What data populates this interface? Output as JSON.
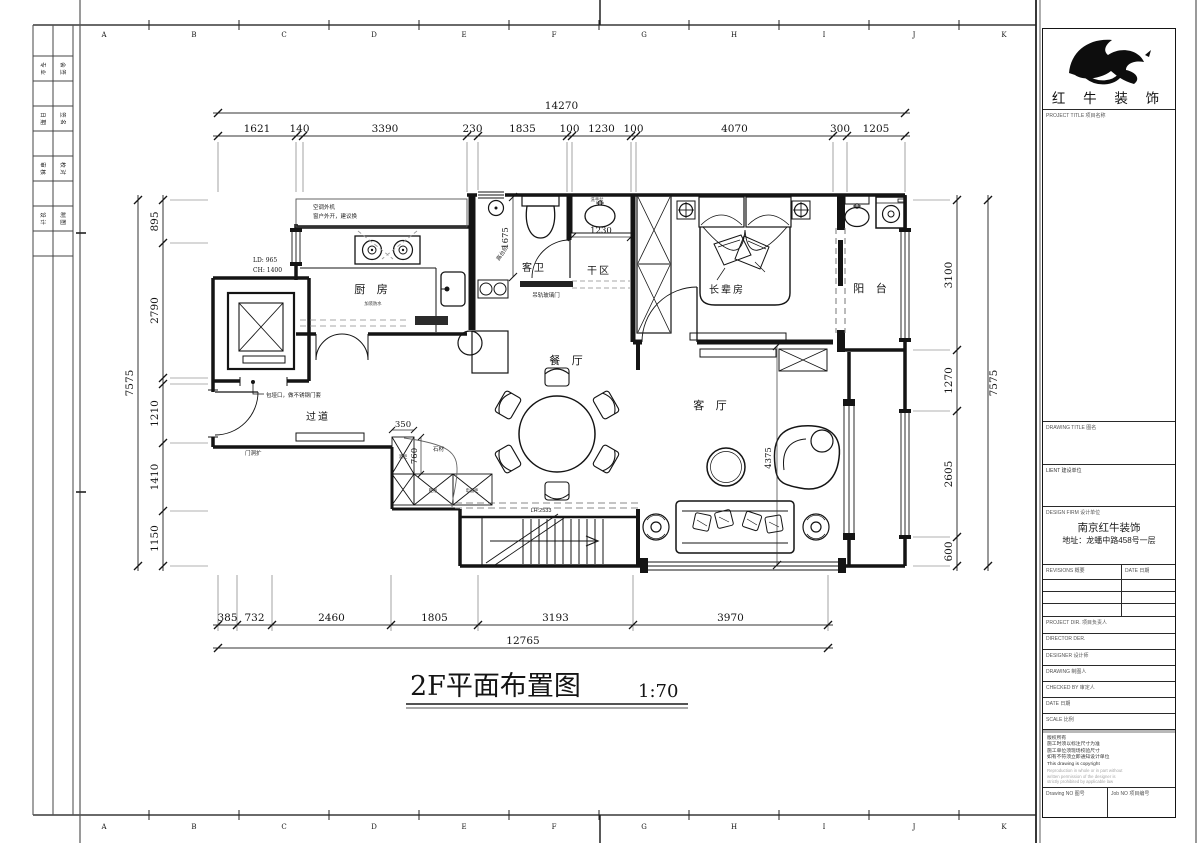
{
  "sheet": {
    "grid_letters": [
      "A",
      "B",
      "C",
      "D",
      "E",
      "F",
      "G",
      "H",
      "I",
      "J",
      "K"
    ],
    "margin_cells": [
      "专 业",
      "会 签",
      "日 期",
      "签 名",
      "审 核",
      "校 对",
      "设 计",
      "制 图"
    ]
  },
  "dims": {
    "top_total": "14270",
    "top": [
      "1621",
      "140",
      "3390",
      "230",
      "1835",
      "100",
      "1230",
      "100",
      "4070",
      "300",
      "1205"
    ],
    "bottom_total": "12765",
    "bottom": [
      "385",
      "732",
      "2460",
      "1805",
      "3193",
      "3970"
    ],
    "left_total": "7575",
    "left": [
      "895",
      "2790",
      "1210",
      "1410",
      "1150"
    ],
    "right_total": "7575",
    "right": [
      "3100",
      "1270",
      "2605",
      "600"
    ],
    "inner": {
      "bath_height": "1675",
      "dry_width": "1230",
      "cab_width": "350",
      "cab_depth": "760",
      "living_height": "4375",
      "stair_note": "LH:2533",
      "elev_ld": "LD: 965",
      "elev_ch": "CH: 1400"
    }
  },
  "rooms": {
    "kitchen": "厨 房",
    "guest_bath": "客卫",
    "dry_area": "干区",
    "elder_room": "长辈房",
    "balcony": "阳 台",
    "dining": "餐 厅",
    "living": "客 厅",
    "corridor": "过道"
  },
  "annotations": {
    "ac_note1": "空调外机",
    "ac_note2": "窗户外开，建议换",
    "kitchen_note": "加装防水",
    "step_note": "高台阶",
    "slide_door": "吊轨玻璃门",
    "opening_note": "包垭口，做不锈钢门套",
    "door_note": "门洞扩",
    "stone": "石材",
    "cab_tall": "酒柜",
    "cab_mid": "鞋柜",
    "cab_right": "电器柜",
    "basin": "洗手盆"
  },
  "title": {
    "text": "2F平面布置图",
    "scale": "1:70"
  },
  "titleblock": {
    "brand": "红 牛 装 饰",
    "project_title_label": "PROJECT TITLE   项目名称",
    "drawing_title_label": "DRAWING TITLE   图名",
    "client_label": "LIENT   建设单位",
    "design_firm_label": "DESIGN FIRM   设计单位",
    "firm_name": "南京红牛装饰",
    "firm_addr": "地址：龙蟠中路458号一层",
    "revisions_label": "REVISIONS   概要",
    "date_col_label": "DATE   日期",
    "project_dir_label": "PROJECT DIR.   项目负责人",
    "director_label": "DIRECTOR DER.",
    "designer_label": "DESIGNER   设计师",
    "drawing_label": "DRAWING   制图人",
    "checked_label": "CHECKED BY   审定人",
    "date_label": "DATE   日期",
    "scale_label": "SCALE   比例",
    "copyright": [
      "版权所有",
      "施工时须以标注尺寸为准",
      "施工单位须现场校验尺寸",
      "如有不符须立即通知设计单位",
      "This drawing is copyright"
    ],
    "copyright_blur": [
      "Reproduction in whole or in part without",
      "written permission of the designer is",
      "strictly prohibited by applicable law"
    ],
    "drawing_no_label": "Drawing NO   图号",
    "job_no_label": "Job NO   项目编号"
  }
}
